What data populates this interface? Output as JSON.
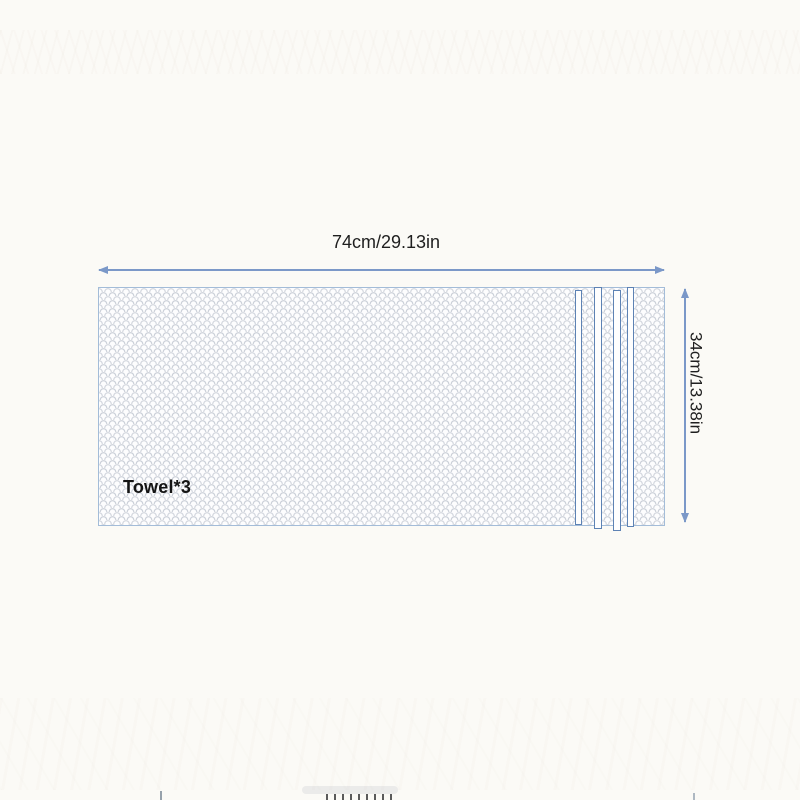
{
  "page": {
    "background_color": "#fbfaf6"
  },
  "diagram": {
    "product_label": "Towel*3",
    "width_label": "74cm/29.13in",
    "height_label": "34cm/13.38in",
    "colors": {
      "dimension_arrow": "#7b98c8",
      "towel_border": "#a3bcd8",
      "stripe_border": "#5d82b4",
      "scale_pattern": "#949eb0",
      "label_text": "#1f1f1f"
    }
  }
}
